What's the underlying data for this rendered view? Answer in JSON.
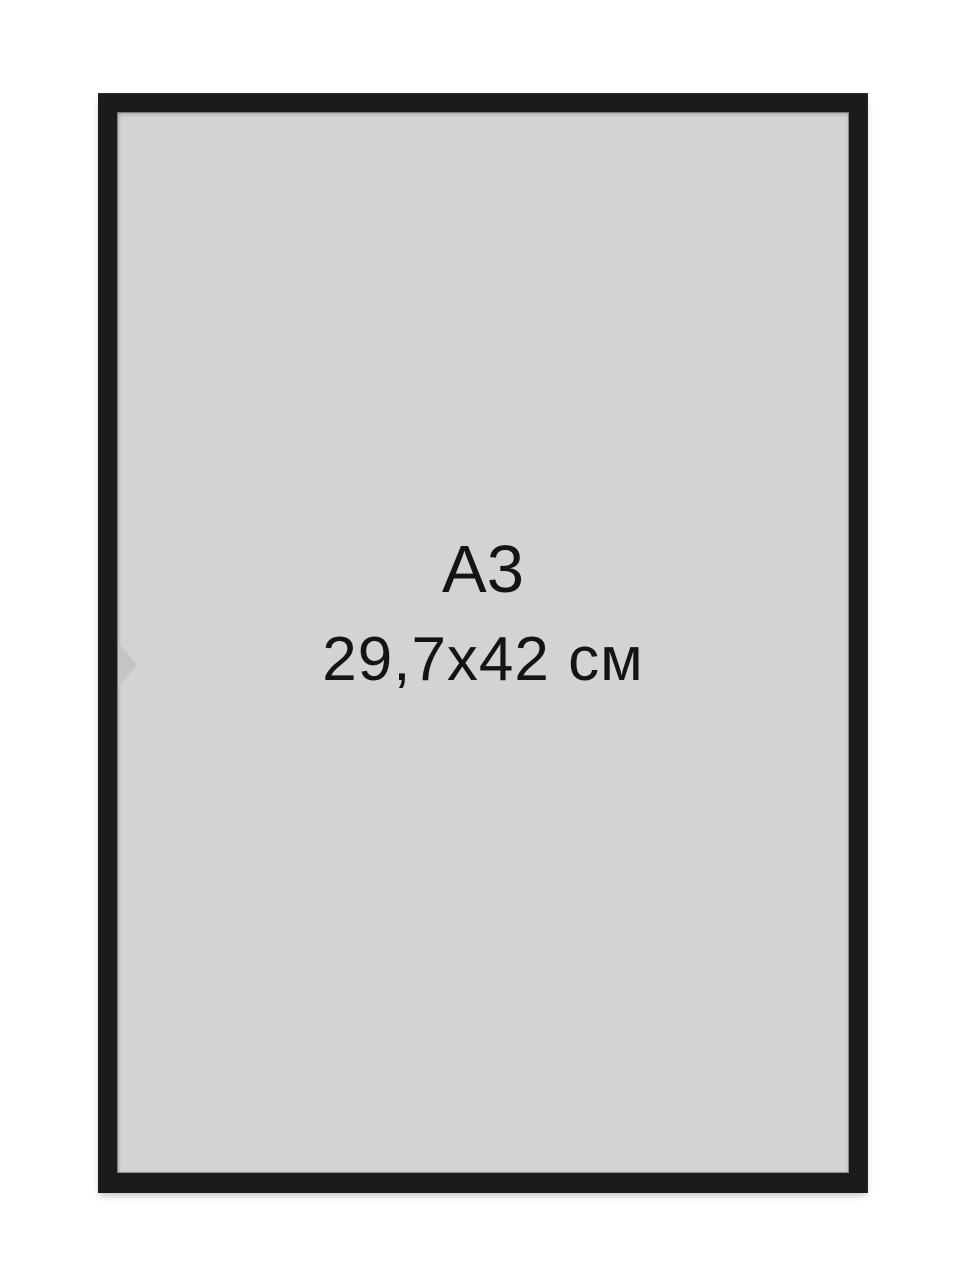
{
  "colors": {
    "background": "#ffffff",
    "frame": "#1b1b1e",
    "mat": "#d3d3d3",
    "text": "#141414",
    "watermark_arrow": "#c3c3c3"
  },
  "product_image": {
    "size_label": "А3",
    "dimensions_label": "29,7x42 см"
  },
  "icons": {
    "chevron_right": "faint right-pointing carousel-style arrow watermark at left mat edge"
  }
}
